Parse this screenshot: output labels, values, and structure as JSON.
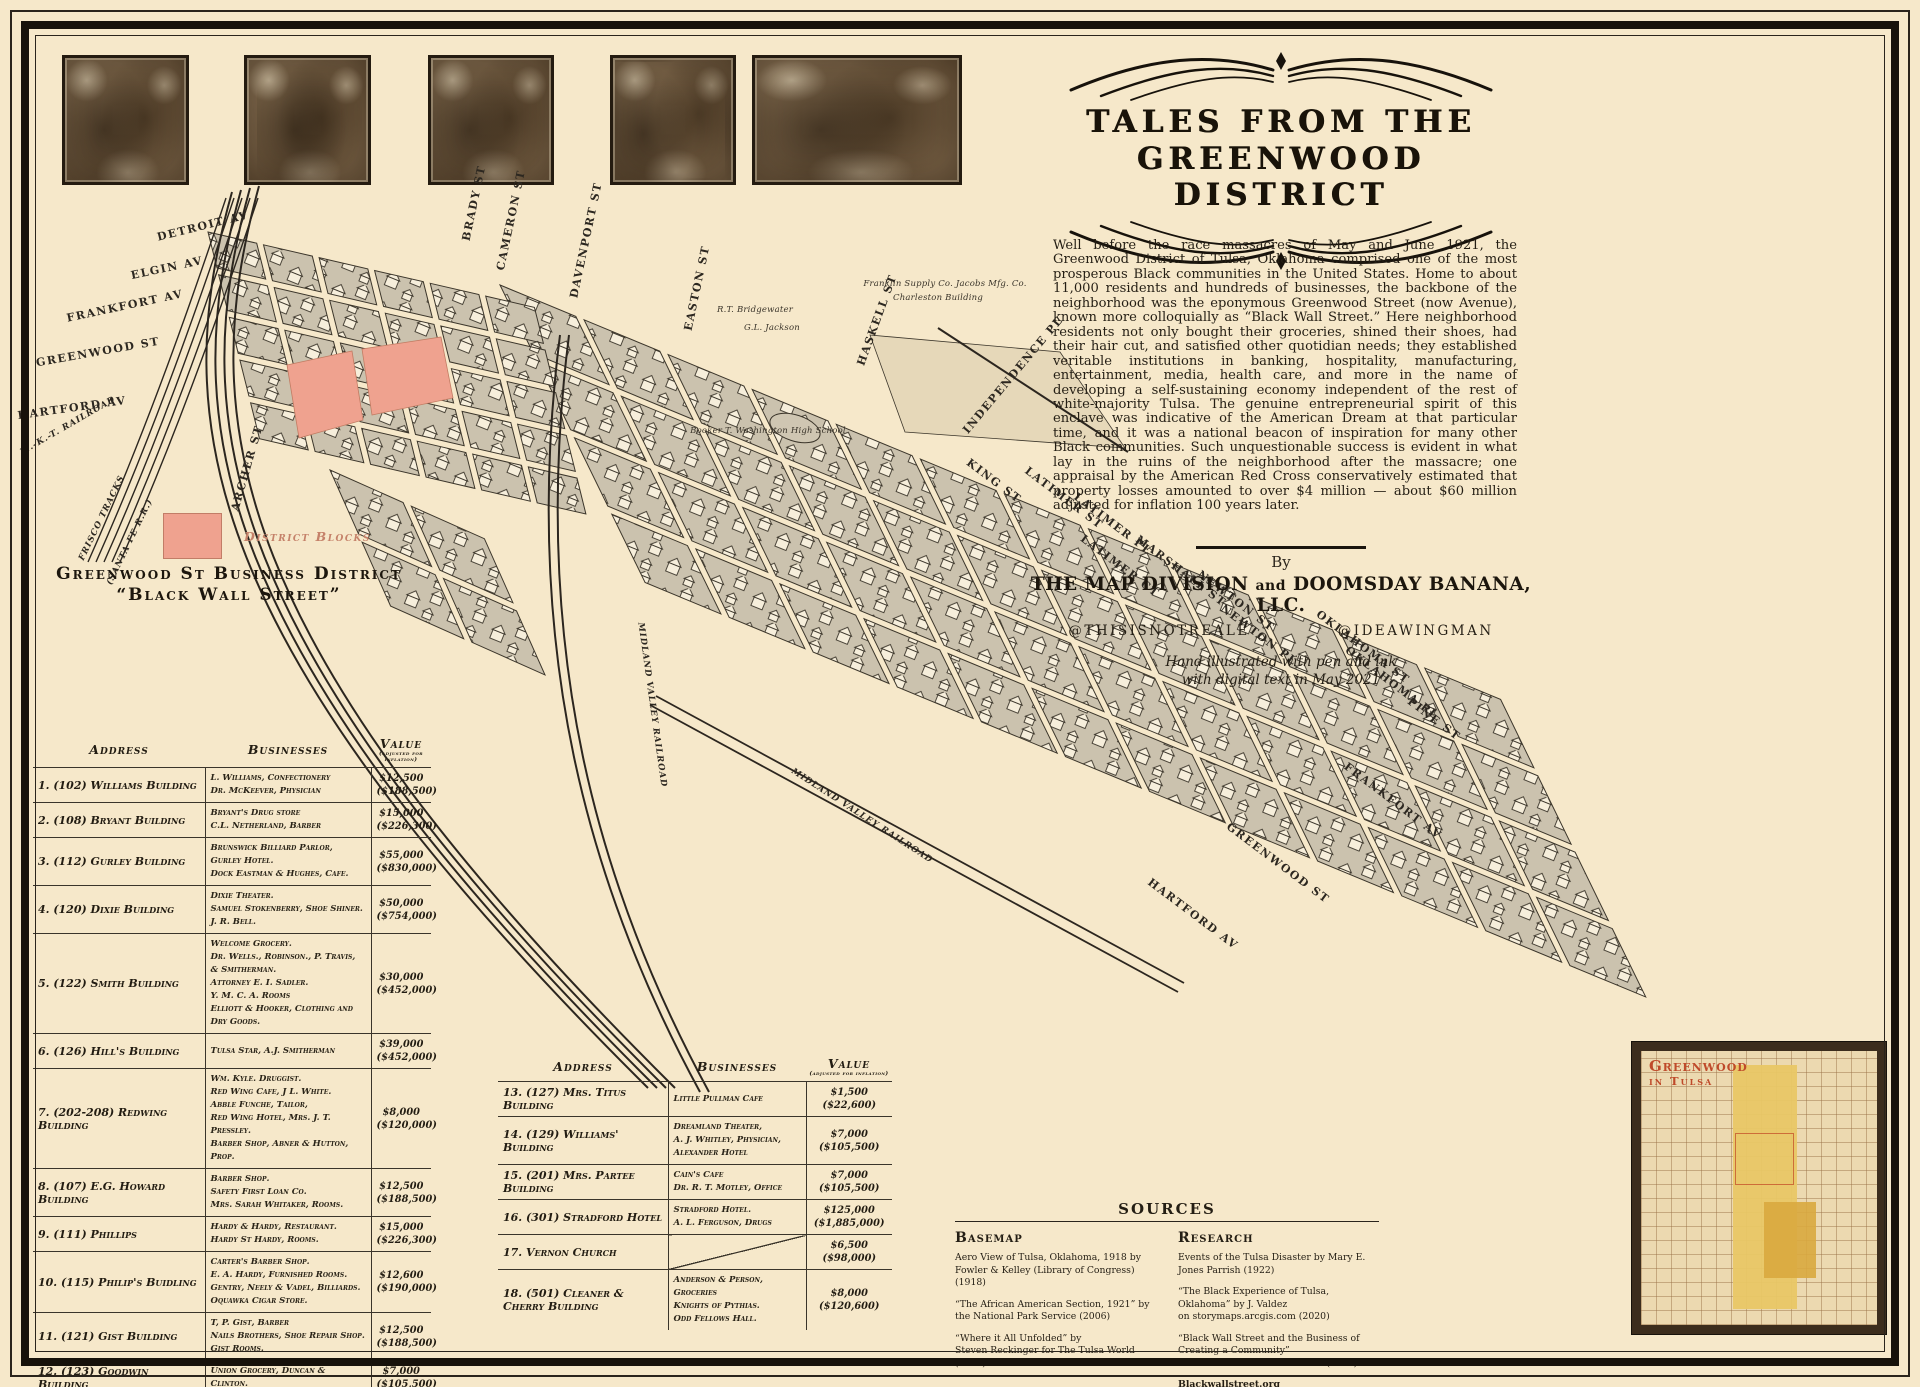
{
  "poster": {
    "title_line1": "Tales From the",
    "title_line2": "Greenwood District",
    "intro": "Well before the race massacres of May and June 1921, the Greenwood District of Tulsa, Oklahoma comprised one of the most prosperous Black communities in the United States. Home to about 11,000 residents and hundreds of businesses, the backbone of the neighborhood was the eponymous Greenwood Street (now Avenue), known more colloquially as “Black Wall Street.” Here neighborhood residents not only bought their groceries, shined their shoes, had their hair cut, and satisfied other quotidian needs; they established veritable institutions in banking, hospitality, manufacturing, entertainment, media, health care, and more in the name of developing a self-sustaining economy independent of the rest of white-majority Tulsa. The genuine entrepreneurial spirit of this enclave was indicative of the American Dream at that particular time, and it was a national beacon of inspiration for many other Black communities. Such unquestionable success is evident in what lay in the ruins of the neighborhood after the massacre; one appraisal by the American Red Cross conservatively estimated that property losses amounted to over $4 million — about $60 million adjusted for inflation 100 years later.",
    "by_label": "By",
    "byline_1": "The Map Division",
    "byline_and": "and",
    "byline_2": "Doomsday Banana, LLC.",
    "handle_left": "@THISISNOTREALE",
    "handle_right": "@IDEAWINGMAN",
    "credit_note_line1": "Hand illustrated with pen and ink",
    "credit_note_line2": "with digital text in May 2021"
  },
  "legend": {
    "label": "District Blocks",
    "swatch_color": "#efa28f"
  },
  "business_table": {
    "title_line1": "Greenwood St Business District",
    "title_line2": "“Black Wall Street”",
    "headers": [
      "Address",
      "Businesses",
      "Value"
    ],
    "value_note": "(adjusted for inflation)",
    "rows": [
      {
        "label": "1. (102) Williams Building",
        "businesses": "L. Williams, Confectionery\nDr. McKeever, Physician",
        "value": "$12,500",
        "adjusted": "($188,500)"
      },
      {
        "label": "2. (108) Bryant Building",
        "businesses": "Bryant's Drug store\nC.L. Netherland, Barber",
        "value": "$15,000",
        "adjusted": "($226,300)"
      },
      {
        "label": "3. (112) Gurley Building",
        "businesses": "Brunswick Billiard Parlor,\nGurley Hotel.\nDock Eastman & Hughes, Cafe.",
        "value": "$55,000",
        "adjusted": "($830,000)"
      },
      {
        "label": "4. (120) Dixie Building",
        "businesses": "Dixie Theater.\nSamuel Stokenberry, Shoe Shiner.\nJ. R. Bell.",
        "value": "$50,000",
        "adjusted": "($754,000)"
      },
      {
        "label": "5. (122) Smith Building",
        "businesses": "Welcome Grocery.\nDr. Wells., Robinson., P. Travis, & Smitherman.\nAttorney E. I. Sadler.\nY. M. C. A. Rooms\nElliott & Hooker, Clothing and Dry Goods.",
        "value": "$30,000",
        "adjusted": "($452,000)"
      },
      {
        "label": "6. (126) Hill's Building",
        "businesses": "Tulsa Star, A.J. Smitherman",
        "value": "$39,000",
        "adjusted": "($452,000)"
      },
      {
        "label": "7. (202-208) Redwing Building",
        "businesses": "Wm. Kyle. Druggist.\nRed Wing Cafe, J L. White.\nAbble Funche, Tailor,\nRed Wing Hotel, Mrs. J. T. Pressley.\nBarber Shop, Abner & Hutton, Prop.",
        "value": "$8,000",
        "adjusted": "($120,000)"
      },
      {
        "label": "8. (107) E.G. Howard Building",
        "businesses": "Barber Shop.\nSafety First Loan Co.\nMrs. Sarah Whitaker, Rooms.",
        "value": "$12,500",
        "adjusted": "($188,500)"
      },
      {
        "label": "9. (111) Phillips",
        "businesses": "Hardy & Hardy, Restaurant.\nHardy St Hardy, Rooms.",
        "value": "$15,000",
        "adjusted": "($226,300)"
      },
      {
        "label": "10. (115) Philip's Buidling",
        "businesses": "Carter's Barber Shop.\nE. A. Hardy, Furnished Rooms.\nGentry, Neely & Vadel, Billiards.\nOquawka Cigar Store.",
        "value": "$12,600",
        "adjusted": "($190,000)"
      },
      {
        "label": "11. (121) Gist Building",
        "businesses": "T, P. Gist, Barber\nNails Brothers, Shoe Repair Shop.\nGist Rooms.",
        "value": "$12,500",
        "adjusted": "($188,500)"
      },
      {
        "label": "12. (123) Goodwin Building",
        "businesses": "Union Grocery, Duncan & Clinton.",
        "value": "$7,000",
        "adjusted": "($105,500)"
      }
    ]
  },
  "business_table2": {
    "headers": [
      "Address",
      "Businesses",
      "Value"
    ],
    "value_note": "(adjusted for inflation)",
    "rows": [
      {
        "label": "13. (127) Mrs. Titus Building",
        "businesses": "Little Pullman Cafe",
        "value": "$1,500",
        "adjusted": "($22,600)"
      },
      {
        "label": "14. (129) Williams' Building",
        "businesses": "Dreamland Theater,\nA. J. Whitley, Physician,\nAlexander Hotel",
        "value": "$7,000",
        "adjusted": "($105,500)"
      },
      {
        "label": "15. (201) Mrs. Partee Building",
        "businesses": "Cain's Cafe\nDr. R. T. Motley, Office",
        "value": "$7,000",
        "adjusted": "($105,500)"
      },
      {
        "label": "16. (301) Stradford Hotel",
        "businesses": "Stradford Hotel.\nA. L. Ferguson, Drugs",
        "value": "$125,000",
        "adjusted": "($1,885,000)"
      },
      {
        "label": "17. Vernon Church",
        "businesses": "",
        "value": "$6,500",
        "adjusted": "($98,000)"
      },
      {
        "label": "18. (501) Cleaner & Cherry Building",
        "businesses": "Anderson & Person, Groceries\nKnights of Pythias.\nOdd Fellows Hall.",
        "value": "$8,000",
        "adjusted": "($120,600)"
      }
    ]
  },
  "sources": {
    "title": "Sources",
    "basemap": {
      "title": "Basemap",
      "entries": [
        "Aero View of Tulsa, Oklahoma, 1918 by\nFowler & Kelley (Library of Congress) (1918)",
        "“The African American Section, 1921” by\nthe National Park Service (2006)",
        "“Where it All Unfolded” by\nSteven Reckinger for The Tulsa World (2020)"
      ]
    },
    "research": {
      "title": "Research",
      "entries": [
        "Events of the Tulsa Disaster by Mary E. Jones Parrish (1922)",
        "“The Black Experience of Tulsa, Oklahoma” by J. Valdez\non storymaps.arcgis.com (2020)",
        "“Black Wall Street and the Business of Creating a Community”\nRetrieved from TicTocLife.com (2021)",
        "Blackwallstreet.org"
      ]
    }
  },
  "inset": {
    "title_line1": "Greenwood",
    "title_line2": "in Tulsa",
    "highlight_color": "#e9c766",
    "title_color": "#bf4a2a"
  },
  "map": {
    "labels": [
      {
        "t": "DETROIT AV",
        "x": 203,
        "y": 226,
        "r": -14,
        "c": "st"
      },
      {
        "t": "ELGIN AV",
        "x": 167,
        "y": 268,
        "r": -12,
        "c": "st"
      },
      {
        "t": "FRANKFORT AV",
        "x": 125,
        "y": 306,
        "r": -12,
        "c": "st"
      },
      {
        "t": "GREENWOOD ST",
        "x": 98,
        "y": 352,
        "r": -10,
        "c": "st"
      },
      {
        "t": "HARTFORD AV",
        "x": 72,
        "y": 408,
        "r": -8,
        "c": "st"
      },
      {
        "t": "M.-K.-T. RAILROAD",
        "x": 68,
        "y": 426,
        "r": -30,
        "c": "rail"
      },
      {
        "t": "FRISCO TRACKS",
        "x": 102,
        "y": 518,
        "r": -64,
        "c": "rail"
      },
      {
        "t": "(SANTA FE R.R.)",
        "x": 130,
        "y": 542,
        "r": -64,
        "c": "rail"
      },
      {
        "t": "ARCHER ST",
        "x": 247,
        "y": 468,
        "r": -74,
        "c": "st"
      },
      {
        "t": "BRADY ST",
        "x": 474,
        "y": 203,
        "r": -78,
        "c": "st"
      },
      {
        "t": "CAMERON ST",
        "x": 511,
        "y": 220,
        "r": -78,
        "c": "st"
      },
      {
        "t": "DAVENPORT ST",
        "x": 586,
        "y": 240,
        "r": -78,
        "c": "st"
      },
      {
        "t": "EASTON ST",
        "x": 697,
        "y": 288,
        "r": -78,
        "c": "st"
      },
      {
        "t": "HASKELL ST",
        "x": 877,
        "y": 320,
        "r": -70,
        "c": "st"
      },
      {
        "t": "INDEPENDENCE PL",
        "x": 1013,
        "y": 375,
        "r": -50,
        "c": "st"
      },
      {
        "t": "KING ST",
        "x": 994,
        "y": 481,
        "r": 37,
        "c": "st"
      },
      {
        "t": "LATIMER ST",
        "x": 1064,
        "y": 498,
        "r": 37,
        "c": "st"
      },
      {
        "t": "LATIMER PL",
        "x": 1113,
        "y": 524,
        "r": 37,
        "c": "st"
      },
      {
        "t": "LATIMER CT",
        "x": 1120,
        "y": 566,
        "r": 37,
        "c": "st"
      },
      {
        "t": "MARSHALL ST",
        "x": 1181,
        "y": 571,
        "r": 37,
        "c": "st"
      },
      {
        "t": "NEWTON ST",
        "x": 1236,
        "y": 601,
        "r": 37,
        "c": "st"
      },
      {
        "t": "NEWTON PL",
        "x": 1259,
        "y": 635,
        "r": 37,
        "c": "st"
      },
      {
        "t": "OKLAHOMA ST",
        "x": 1363,
        "y": 647,
        "r": 37,
        "c": "st"
      },
      {
        "t": "OKLAHOMA PL",
        "x": 1392,
        "y": 683,
        "r": 37,
        "c": "st"
      },
      {
        "t": "PINE ST",
        "x": 1434,
        "y": 719,
        "r": 37,
        "c": "st"
      },
      {
        "t": "FRANKFORT AV",
        "x": 1393,
        "y": 801,
        "r": 37,
        "c": "st"
      },
      {
        "t": "GREENWOOD ST",
        "x": 1278,
        "y": 863,
        "r": 37,
        "c": "st"
      },
      {
        "t": "HARTFORD AV",
        "x": 1193,
        "y": 914,
        "r": 37,
        "c": "st"
      },
      {
        "t": "MIDLAND VALLEY RAILROAD",
        "x": 862,
        "y": 816,
        "r": 33,
        "c": "rail"
      },
      {
        "t": "MIDLAND VALLEY RAILROAD",
        "x": 652,
        "y": 705,
        "r": 82,
        "c": "rail"
      },
      {
        "t": "R.T. Bridgewater",
        "x": 755,
        "y": 310,
        "r": 0,
        "c": "bld"
      },
      {
        "t": "G.L. Jackson",
        "x": 772,
        "y": 328,
        "r": 0,
        "c": "bld"
      },
      {
        "t": "Franklin Supply Co.  Jacobs Mfg. Co.",
        "x": 945,
        "y": 284,
        "r": 0,
        "c": "bld"
      },
      {
        "t": "Charleston Building",
        "x": 938,
        "y": 298,
        "r": 0,
        "c": "bld"
      },
      {
        "t": "Booker T. Washington High School",
        "x": 768,
        "y": 431,
        "r": 0,
        "c": "bld"
      }
    ]
  }
}
